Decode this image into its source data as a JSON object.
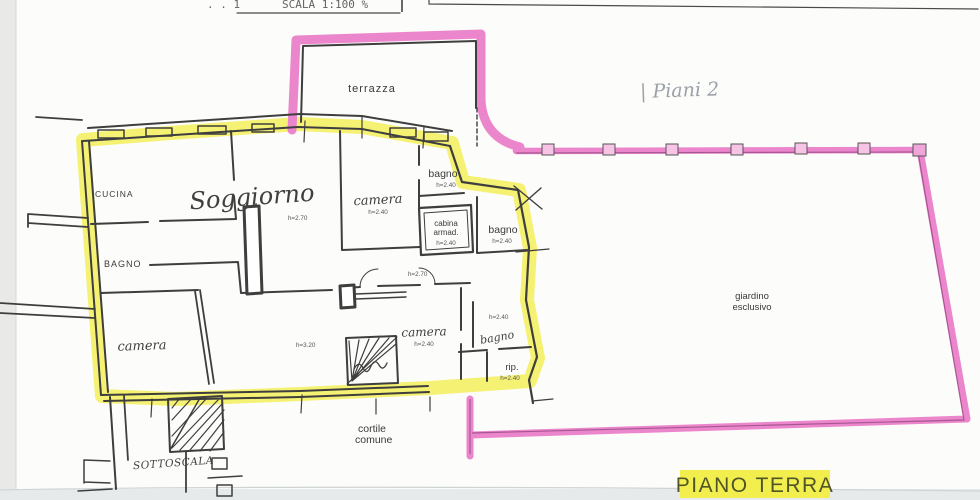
{
  "header": {
    "doc_fragment": ". . 1",
    "scale_label": "SCALA 1:100 %"
  },
  "notes": {
    "piani": "| Piani 2",
    "piano_terra": "PIANO TERRA"
  },
  "outdoor": {
    "terrazza": "terrazza",
    "giardino": {
      "line1": "giardino",
      "line2": "esclusivo"
    },
    "cortile": {
      "line1": "cortile",
      "line2": "comune"
    },
    "sottoscala": "SOTTOSCALA"
  },
  "rooms": {
    "cucina": {
      "label": "CUCINA"
    },
    "soggiorno": {
      "label": "Soggiorno",
      "height": "h=2.70"
    },
    "bagno_left": {
      "label": "BAGNO"
    },
    "camera_nw": {
      "label": "camera",
      "height": "h=2.40"
    },
    "camera_sw": {
      "label": "camera",
      "height": "h=3.20"
    },
    "camera_s": {
      "label": "camera",
      "height": "h=2.40"
    },
    "bagno_top": {
      "label": "bagno",
      "height": "h=2.40"
    },
    "bagno_right": {
      "label": "bagno",
      "height": "h=2.40"
    },
    "bagno_s": {
      "label": "bagno",
      "height": "h=2.40"
    },
    "cabina": {
      "line1": "cabina",
      "line2": "armad.",
      "height": "h=2.40"
    },
    "rip": {
      "label": "rip.",
      "height": "h=2.40"
    },
    "corridoio": {
      "height": "h=2.70"
    }
  },
  "colors": {
    "highlight_yellow": "#f3ee50",
    "boundary_pink": "#ec86cc",
    "ink": "#3e3e3e",
    "handwriting_gray": "#9aa0a8",
    "piano_terra_text": "#4f5526"
  }
}
